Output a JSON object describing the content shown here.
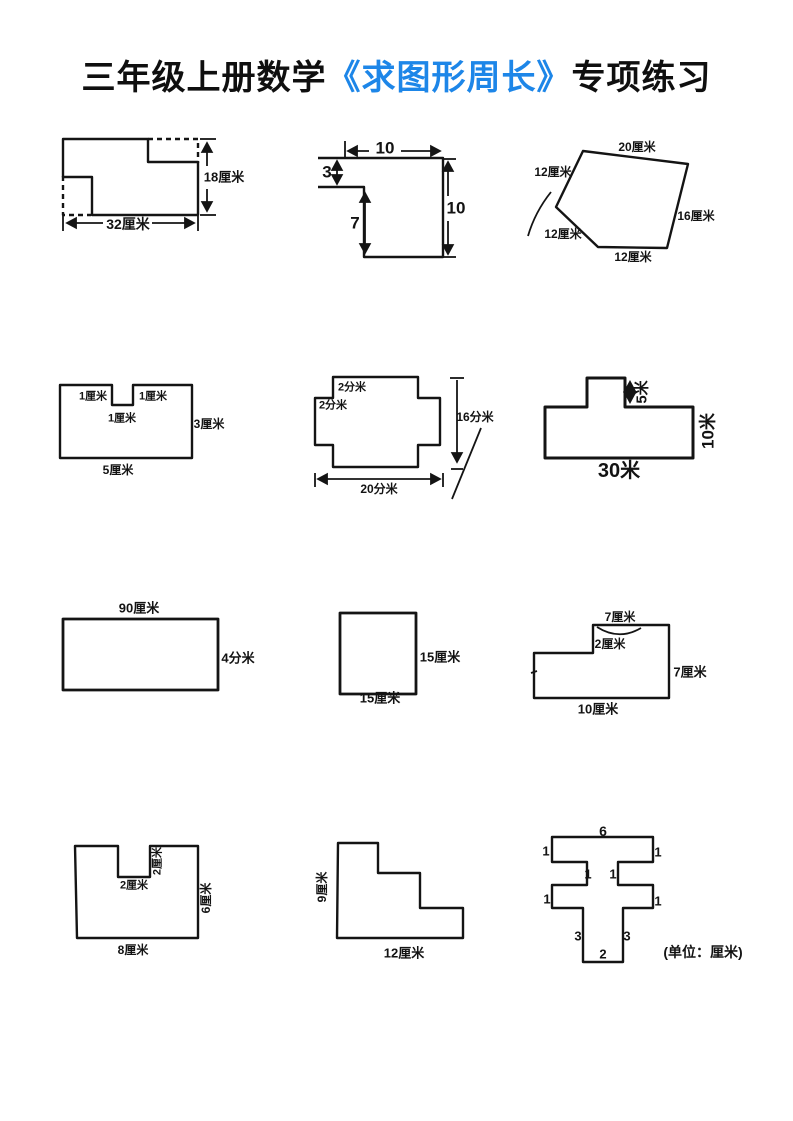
{
  "title": {
    "prefix": "三年级上册数学",
    "highlight": "《求图形周长》",
    "suffix": "专项练习"
  },
  "accent_blue": "#1d86e8",
  "ink_color": "#141414",
  "unit_note": "(单位：厘米)",
  "figures": {
    "f1": {
      "height": "18厘米",
      "width": "32厘米"
    },
    "f2": {
      "top": "10",
      "left": "3",
      "inner": "7",
      "right": "10"
    },
    "f3": {
      "top": "20厘米",
      "upper_left": "12厘米",
      "lower_left": "12厘米",
      "bottom": "12厘米",
      "right": "16厘米"
    },
    "f4": {
      "notch_left": "1厘米",
      "notch_right": "1厘米",
      "notch_depth": "1厘米",
      "right": "3厘米",
      "bottom": "5厘米"
    },
    "f5": {
      "step_top": "2分米",
      "step_left": "2分米",
      "right": "16分米",
      "bottom": "20分米"
    },
    "f6": {
      "bump": "5米",
      "right": "10米",
      "bottom": "30米"
    },
    "f7": {
      "top": "90厘米",
      "right": "4分米"
    },
    "f8": {
      "right": "15厘米",
      "bottom": "15厘米"
    },
    "f9": {
      "top": "7厘米",
      "step": "2厘米",
      "right": "7厘米",
      "bottom": "10厘米"
    },
    "f10": {
      "notch_height": "2厘米",
      "notch_width": "2厘米",
      "right": "6厘米",
      "bottom": "8厘米"
    },
    "f11": {
      "left": "9厘米",
      "bottom": "12厘米"
    },
    "f12": {
      "top": "6",
      "top_left": "1",
      "top_right": "1",
      "neck_left": "1",
      "neck_right": "1",
      "mid_left": "1",
      "mid_right": "1",
      "stem_left": "3",
      "stem_right": "3",
      "bottom": "2"
    }
  }
}
